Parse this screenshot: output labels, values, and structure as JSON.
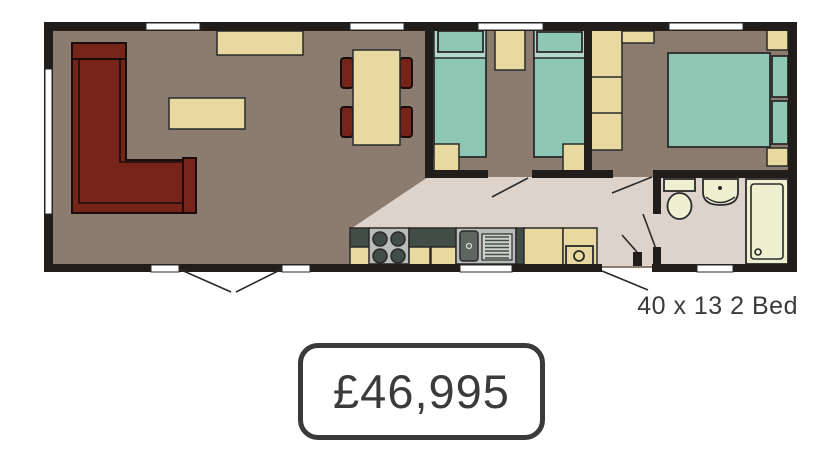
{
  "floorplan": {
    "model_label": "40 x 13 2 Bed",
    "price_label": "£46,995",
    "furniture_icons": [
      "corner-sofa-icon",
      "coffee-table-icon",
      "sideboard-icon",
      "dining-table-icon",
      "dining-chair-icon",
      "single-bed-icon",
      "pillow-icon",
      "bedside-unit-icon",
      "ottoman-icon",
      "wardrobe-icon",
      "shelf-icon",
      "double-bed-icon",
      "kitchen-counter-icon",
      "hob-icon",
      "sink-drainer-icon",
      "kitchen-cabinet-icon",
      "washing-machine-icon",
      "toilet-icon",
      "basin-icon",
      "shower-icon",
      "window-icon",
      "door-swing-icon"
    ]
  },
  "colors": {
    "wall": "#201d1a",
    "floor-brown": "#8c7c6f",
    "floor-pale": "#ded3cb",
    "cream": "#e7d9a0",
    "teal": "#8ec7b4",
    "teal-band": "#b5d8cc",
    "sofa-red": "#76231a",
    "counter-dark": "#434d47",
    "appliance-gray": "#b9bcb9",
    "sink-dark": "#5f6661",
    "fixture-cream": "#eef0d2",
    "ink": "#3b3b3b",
    "line": "#2a2a2a"
  }
}
